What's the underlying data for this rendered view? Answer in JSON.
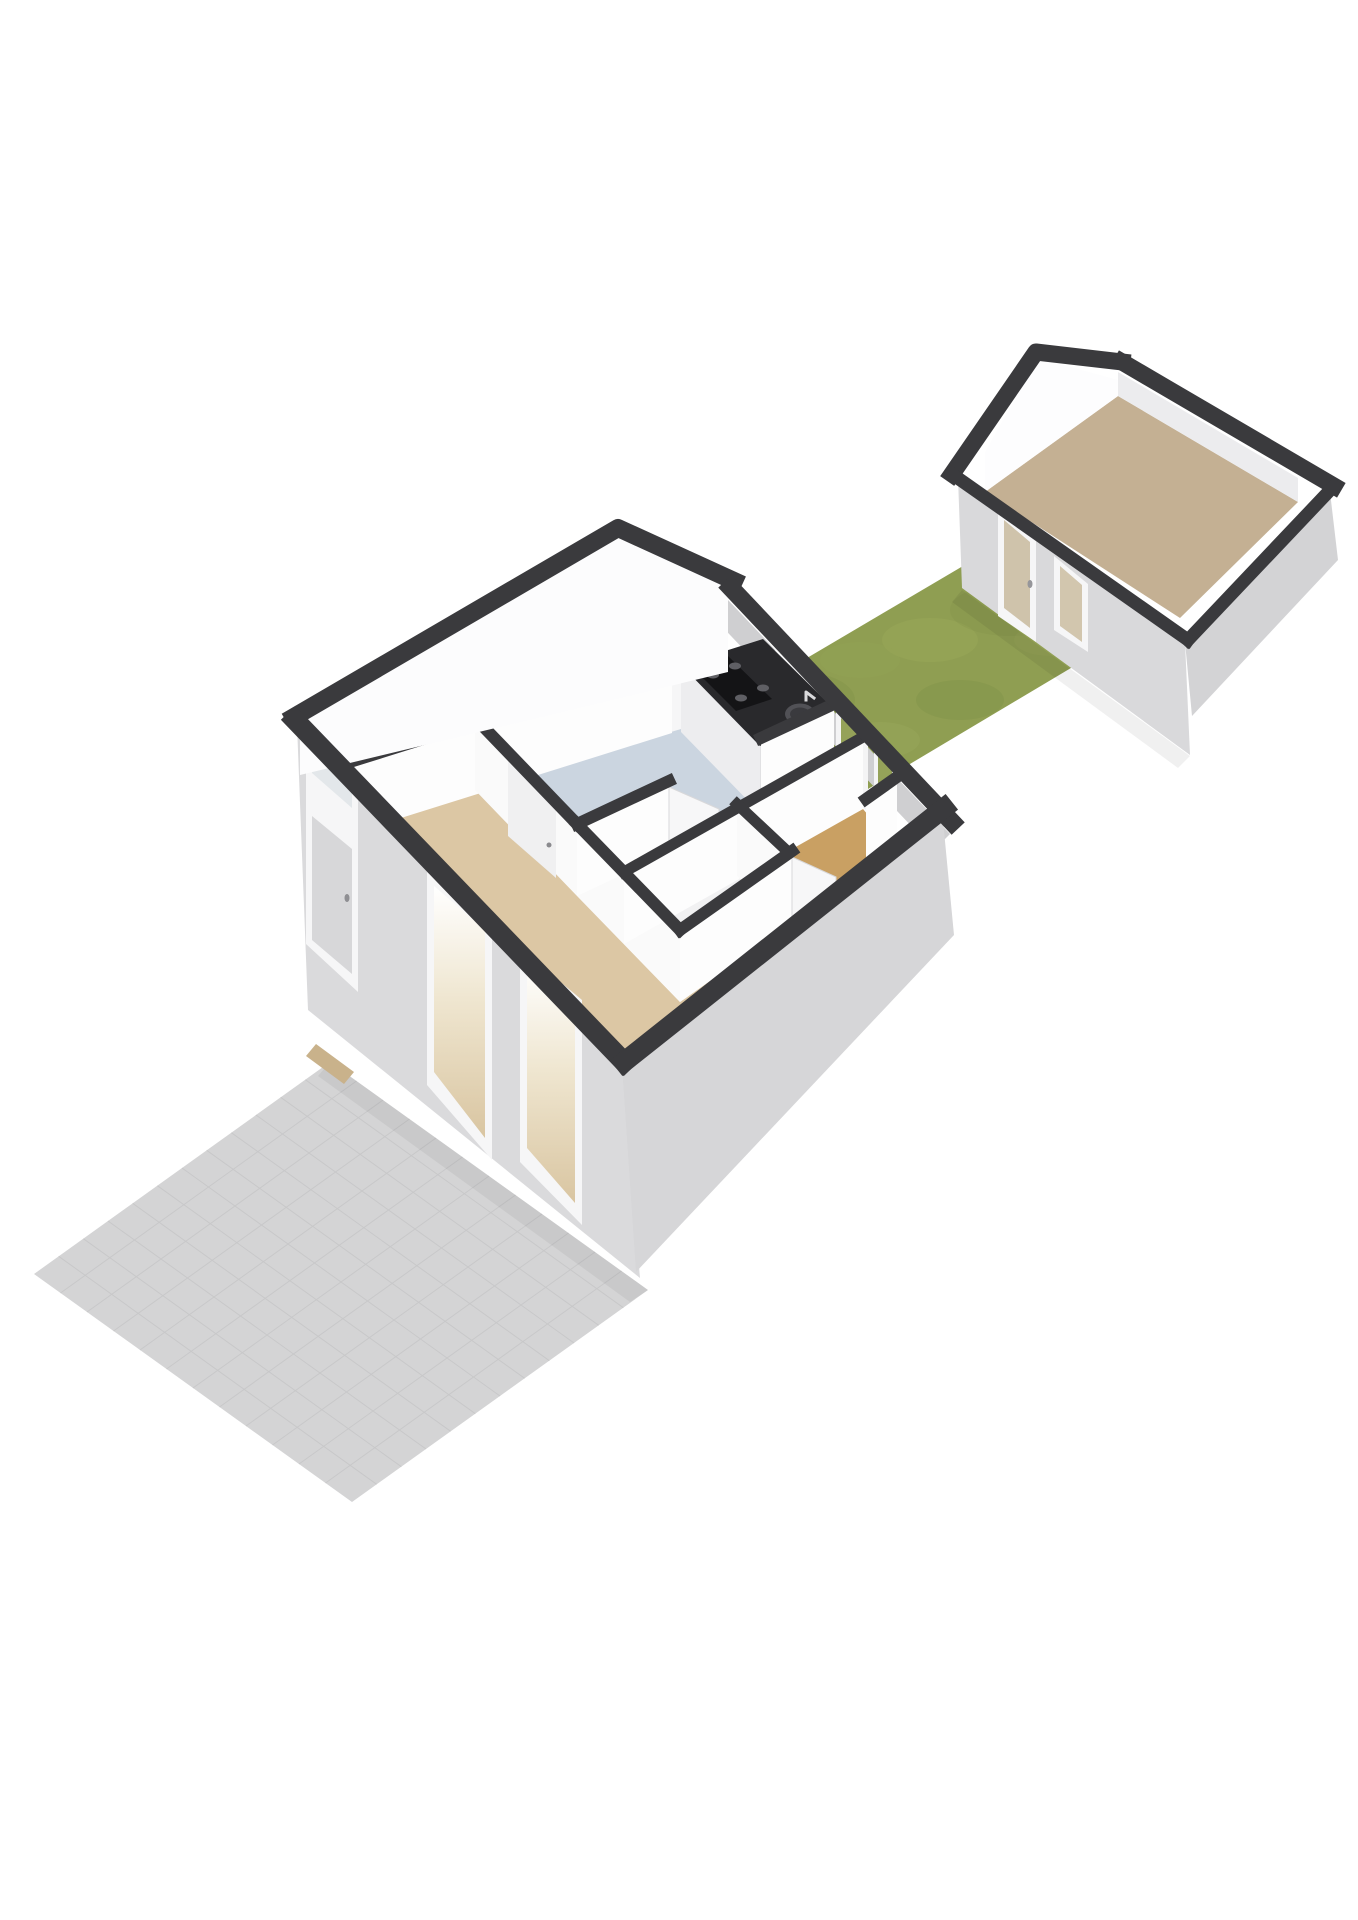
{
  "meta": {
    "description": "3D isometric floor plan render: tiled patio (bottom-left), main house ground floor with kitchen, hall, bathroom, toilet and living room, grass garden and detached shed (top-right)",
    "canvas": {
      "width": 1358,
      "height": 1920,
      "background": "#ffffff"
    },
    "palette": {
      "wall_top": "#3a3a3d",
      "wall_exterior": "#d9d9db",
      "wall_interior": "#fdfdfd",
      "kitchen_floor": "#cbd5e0",
      "living_floor": "#dcc7a4",
      "toilet_floor": "#c9a063",
      "shed_floor": "#c4b093",
      "grass": "#8f9e52",
      "patio": "#d4d4d5",
      "counter_top": "#29292c",
      "glass_to_garden": "#95a259"
    },
    "rooms": [
      {
        "name": "entry-corridor",
        "floor": "#f6f6f7"
      },
      {
        "name": "kitchen",
        "floor": "#cbd5e0"
      },
      {
        "name": "inner-hall",
        "floor": "#f6f6f7"
      },
      {
        "name": "bathroom",
        "floor": "#f1f1f2"
      },
      {
        "name": "toilet",
        "floor": "#c9a063"
      },
      {
        "name": "living-room",
        "floor": "#dcc7a4"
      },
      {
        "name": "shed",
        "floor": "#c4b093"
      }
    ]
  },
  "scene": {
    "layers": [
      {
        "name": "patio-surface",
        "kind": "polygon",
        "points": "330,1062 648,1290 352,1502 34,1274",
        "fill": "#d4d4d5"
      },
      {
        "name": "patio-tile-grid",
        "kind": "grid",
        "quad": "330,1062 648,1290 352,1502 34,1274",
        "div": 12,
        "stroke": "#c6c6c8",
        "width": 1,
        "opacity": 0.85
      },
      {
        "name": "patio-house-shadow",
        "kind": "polygon",
        "points": "330,1062 648,1290 630,1302 318,1076",
        "fill": "#000000",
        "opacity": 0.05
      },
      {
        "name": "front-door-threshold",
        "kind": "polygon",
        "points": "316,1044 354,1072 344,1084 306,1056",
        "fill": "#c9b28b"
      },
      {
        "name": "garden-grass",
        "kind": "polygon",
        "points": "690,727 1002,543 1128,634 816,820",
        "fill": "#8f9e52"
      },
      {
        "name": "grass-texture-blob",
        "kind": "ellipse",
        "cx": 800,
        "cy": 700,
        "rx": 55,
        "ry": 28,
        "fill": "#7f9047",
        "opacity": 0.3
      },
      {
        "name": "grass-texture-blob",
        "kind": "ellipse",
        "cx": 930,
        "cy": 640,
        "rx": 48,
        "ry": 22,
        "fill": "#a2b05f",
        "opacity": 0.28
      },
      {
        "name": "grass-texture-blob",
        "kind": "ellipse",
        "cx": 1010,
        "cy": 610,
        "rx": 60,
        "ry": 26,
        "fill": "#7f9047",
        "opacity": 0.25
      },
      {
        "name": "grass-texture-blob",
        "kind": "ellipse",
        "cx": 880,
        "cy": 740,
        "rx": 40,
        "ry": 18,
        "fill": "#a6b263",
        "opacity": 0.22
      },
      {
        "name": "grass-texture-blob",
        "kind": "ellipse",
        "cx": 960,
        "cy": 700,
        "rx": 44,
        "ry": 20,
        "fill": "#7c8d45",
        "opacity": 0.3
      },
      {
        "name": "grass-texture-blob",
        "kind": "ellipse",
        "cx": 1050,
        "cy": 640,
        "rx": 36,
        "ry": 16,
        "fill": "#9aa85a",
        "opacity": 0.25
      },
      {
        "name": "grass-texture-blob",
        "kind": "ellipse",
        "cx": 760,
        "cy": 760,
        "rx": 50,
        "ry": 22,
        "fill": "#7c8d45",
        "opacity": 0.22
      },
      {
        "name": "grass-texture-blob",
        "kind": "ellipse",
        "cx": 860,
        "cy": 660,
        "rx": 40,
        "ry": 18,
        "fill": "#95a455",
        "opacity": 0.3
      },
      {
        "name": "garden-house-shadow",
        "kind": "polygon",
        "points": "698,726 860,864 844,872 688,738",
        "fill": "#000000",
        "opacity": 0.07
      },
      {
        "name": "shed-grass-shadow",
        "kind": "polygon",
        "points": "962,590 1190,756 1178,768 952,602",
        "fill": "#000000",
        "opacity": 0.06
      },
      {
        "name": "shed-floor",
        "kind": "polygon",
        "points": "985,492 1118,396 1298,502 1180,618",
        "fill": "#c4b093"
      },
      {
        "name": "shed-gable-inner-face",
        "kind": "polygon",
        "points": "985,492 1118,396 1118,380 1038,358 985,452",
        "fill": "#fdfdfe"
      },
      {
        "name": "shed-ne-inner-face",
        "kind": "polygon",
        "points": "1118,396 1298,502 1298,478 1118,372",
        "fill": "#ececee"
      },
      {
        "name": "shed-sw-ext-face",
        "kind": "polygon",
        "points": "958,478 1185,642 1190,755 962,588",
        "fill": "#d9d9db"
      },
      {
        "name": "shed-se-ext-face",
        "kind": "polygon",
        "points": "1185,642 1330,492 1338,560 1192,716",
        "fill": "#d3d3d5"
      },
      {
        "name": "shed-door-frame",
        "kind": "polygon",
        "points": "998,508 1036,539 1036,642 998,616",
        "fill": "#f6f6f7"
      },
      {
        "name": "shed-door-glass",
        "kind": "polygon",
        "points": "1004,520 1030,542 1030,628 1004,608",
        "fill": "#cfc3ab"
      },
      {
        "name": "shed-door-handle",
        "kind": "ellipse",
        "cx": 1030,
        "cy": 584,
        "rx": 2.5,
        "ry": 4,
        "fill": "#96969a"
      },
      {
        "name": "shed-window-frame",
        "kind": "polygon",
        "points": "1054,556 1088,584 1088,652 1054,630",
        "fill": "#f6f6f7"
      },
      {
        "name": "shed-window-glass",
        "kind": "polygon",
        "points": "1060,566 1082,585 1082,642 1060,626",
        "fill": "#d2c6ae"
      },
      {
        "name": "shed-gable-roof-band",
        "kind": "polyline",
        "points": "952,474 1036,352 1122,362",
        "stroke": "#3a3a3d",
        "width": 17
      },
      {
        "name": "shed-ne-wall-band",
        "kind": "polyline",
        "points": "1122,362 1334,486",
        "stroke": "#3a3a3d",
        "width": 17
      },
      {
        "name": "shed-se-wall-band",
        "kind": "polyline",
        "points": "1334,486 1188,640",
        "stroke": "#3a3a3d",
        "width": 13
      },
      {
        "name": "shed-sw-wall-band",
        "kind": "polyline",
        "points": "952,474 1188,640",
        "stroke": "#3a3a3d",
        "width": 13
      },
      {
        "name": "house-ne-wall-outer-face",
        "kind": "polygon",
        "points": "728,600 950,834 934,850 713,617",
        "fill": "#cfcfd1"
      },
      {
        "name": "floor-corridor",
        "kind": "polygon",
        "points": "300,775 728,672 762,705 353,833",
        "fill": "#f6f6f7"
      },
      {
        "name": "floor-kitchen",
        "kind": "polygon",
        "points": "475,790 762,705 834,776 577,896",
        "fill": "#cbd5e0"
      },
      {
        "name": "floor-inner-hall",
        "kind": "polygon",
        "points": "577,896 834,776 863,809 624,944",
        "fill": "#f6f6f7"
      },
      {
        "name": "floor-bathroom",
        "kind": "polygon",
        "points": "624,944 737,876 786,922 680,1002",
        "fill": "#f1f1f2"
      },
      {
        "name": "floor-toilet",
        "kind": "polygon",
        "points": "737,876 863,809 897,849 786,922",
        "fill": "#c9a063"
      },
      {
        "name": "floor-living-room",
        "kind": "polygon",
        "points": "353,833 475,790 680,1002 897,849 940,880 630,1140",
        "fill": "#dcc7a4"
      },
      {
        "name": "kitchen-window-frame",
        "kind": "polygon",
        "points": "775,650 825,694 825,762 775,716",
        "fill": "#f4f4f5"
      },
      {
        "name": "kitchen-window-glass",
        "kind": "polygon",
        "points": "781,661 819,694 819,752 781,717",
        "fill": "#95a259"
      },
      {
        "name": "back-door-frame",
        "kind": "polygon",
        "points": "836,708 868,736 868,812 836,786",
        "fill": "#f4f4f5"
      },
      {
        "name": "back-door-glass",
        "kind": "polygon",
        "points": "841,718 863,737 863,802 841,783",
        "fill": "#95a259"
      },
      {
        "name": "toilet-window-frame",
        "kind": "polygon",
        "points": "874,748 896,767 896,838 874,820",
        "fill": "#f4f4f5"
      },
      {
        "name": "toilet-window-glass",
        "kind": "polygon",
        "points": "878,756 892,768 892,828 878,816",
        "fill": "#95a259"
      },
      {
        "name": "kitchen-counter-front-face",
        "kind": "polygon",
        "points": "681,665 760,746 760,813 681,732",
        "fill": "#ededef"
      },
      {
        "name": "kitchen-counter-side-face",
        "kind": "polygon",
        "points": "760,746 834,709 834,776 760,813",
        "fill": "#e1e1e3"
      },
      {
        "name": "kitchen-counter-top",
        "kind": "polygon",
        "points": "681,665 763,639 834,709 760,746",
        "fill": "#29292c"
      },
      {
        "name": "cooktop",
        "kind": "polygon",
        "points": "692,667 728,656 772,699 736,711",
        "fill": "#141416"
      },
      {
        "name": "cooktop-burner",
        "kind": "ellipse",
        "cx": 713,
        "cy": 675,
        "rx": 6,
        "ry": 3.5,
        "fill": "#5f5f64"
      },
      {
        "name": "cooktop-burner",
        "kind": "ellipse",
        "cx": 735,
        "cy": 666,
        "rx": 6,
        "ry": 3.5,
        "fill": "#5f5f64"
      },
      {
        "name": "cooktop-burner",
        "kind": "ellipse",
        "cx": 741,
        "cy": 698,
        "rx": 6,
        "ry": 3.5,
        "fill": "#5f5f64"
      },
      {
        "name": "cooktop-burner",
        "kind": "ellipse",
        "cx": 763,
        "cy": 688,
        "rx": 6,
        "ry": 3.5,
        "fill": "#5f5f64"
      },
      {
        "name": "kitchen-sink-outer",
        "kind": "ellipse",
        "cx": 800,
        "cy": 714,
        "rx": 15,
        "ry": 10.5,
        "fill": "#515156"
      },
      {
        "name": "kitchen-sink-basin",
        "kind": "ellipse",
        "cx": 800,
        "cy": 714,
        "rx": 10,
        "ry": 6.5,
        "fill": "#3a3a3e"
      },
      {
        "name": "kitchen-faucet",
        "kind": "polyline",
        "points": "806,700 806,692 814,698",
        "stroke": "#d9d9db",
        "width": 3
      },
      {
        "name": "wall-corridor-face",
        "kind": "polygon",
        "points": "353,767 672,667 672,733 353,833",
        "fill": "#fdfdfd"
      },
      {
        "name": "wall-kitchen-living-face",
        "kind": "polygon",
        "points": "475,724 577,830 577,896 475,790",
        "fill": "#fafafa"
      },
      {
        "name": "kitchen-living-door-panel",
        "kind": "polygon",
        "points": "508,760 556,806 556,878 508,836",
        "fill": "#f0f0f1"
      },
      {
        "name": "kitchen-living-door-handle",
        "kind": "ellipse",
        "cx": 549,
        "cy": 845,
        "rx": 2.5,
        "ry": 2.5,
        "fill": "#8a8a8e"
      },
      {
        "name": "wall-living-bath-face",
        "kind": "polygon",
        "points": "577,830 680,936 680,1002 577,896",
        "fill": "#fafafa"
      },
      {
        "name": "kitchen-hall-wall-face-left",
        "kind": "polygon",
        "points": "577,830 669,787 669,853 577,896",
        "fill": "#fdfdfd"
      },
      {
        "name": "kitchen-open-door",
        "kind": "polygon",
        "points": "669,787 719,809 719,875 669,853",
        "fill": "#f7f7f8",
        "stroke": "#d8d8da",
        "strokeWidth": 1
      },
      {
        "name": "kitchen-hall-wall-face-right",
        "kind": "polygon",
        "points": "761,744 834,710 834,776 761,810",
        "fill": "#fdfdfd"
      },
      {
        "name": "wall-hall-bath-face",
        "kind": "polygon",
        "points": "624,878 863,743 863,809 624,944",
        "fill": "#fdfdfd"
      },
      {
        "name": "wall-bath-toilet-face",
        "kind": "polygon",
        "points": "737,810 786,856 786,922 737,876",
        "fill": "#fafafa"
      },
      {
        "name": "wall-bathblock-se-face-left",
        "kind": "polygon",
        "points": "680,936 792,857 792,923 680,1002",
        "fill": "#fdfdfd"
      },
      {
        "name": "toilet-open-door",
        "kind": "polygon",
        "points": "792,857 836,877 836,943 792,923",
        "fill": "#f7f7f8",
        "stroke": "#d8d8da",
        "strokeWidth": 1
      },
      {
        "name": "wall-bathblock-se-face-right",
        "kind": "polygon",
        "points": "866,805 897,783 897,849 866,871",
        "fill": "#fdfdfd"
      },
      {
        "name": "wall-corridor-band",
        "kind": "polyline",
        "points": "353,761 672,661",
        "stroke": "#3a3a3d",
        "width": 12
      },
      {
        "name": "wall-kitchen-living-band",
        "kind": "polyline",
        "points": "475,718 577,824",
        "stroke": "#3a3a3d",
        "width": 12
      },
      {
        "name": "wall-living-bath-band",
        "kind": "polyline",
        "points": "577,824 680,930",
        "stroke": "#3a3a3d",
        "width": 12
      },
      {
        "name": "wall-hall-bath-band",
        "kind": "polyline",
        "points": "624,872 863,737",
        "stroke": "#3a3a3d",
        "width": 11
      },
      {
        "name": "wall-bath-toilet-band",
        "kind": "polyline",
        "points": "737,804 786,850",
        "stroke": "#3a3a3d",
        "width": 11
      },
      {
        "name": "wall-bathblock-band-left",
        "kind": "polyline",
        "points": "680,930 792,851",
        "stroke": "#3a3a3d",
        "width": 12
      },
      {
        "name": "wall-bathblock-band-right",
        "kind": "polyline",
        "points": "866,799 897,777",
        "stroke": "#3a3a3d",
        "width": 12
      },
      {
        "name": "kitchen-hall-band-left",
        "kind": "polyline",
        "points": "577,824 669,781",
        "stroke": "#3a3a3d",
        "width": 12
      },
      {
        "name": "kitchen-hall-band-right",
        "kind": "polyline",
        "points": "761,738 834,704",
        "stroke": "#3a3a3d",
        "width": 12
      },
      {
        "name": "facade-face",
        "kind": "polygon",
        "points": "297,725 622,1065 640,1278 308,1010",
        "fill": "#dadadc"
      },
      {
        "name": "front-door-frame",
        "kind": "polygon",
        "points": "306,738 358,783 358,992 306,944",
        "fill": "#f6f6f7"
      },
      {
        "name": "front-door-transom",
        "kind": "polygon",
        "points": "312,750 352,785 352,808 312,773",
        "fill": "#e3e7ea"
      },
      {
        "name": "front-door-panel",
        "kind": "polygon",
        "points": "312,816 352,849 352,974 312,940",
        "fill": "#d7d7d9"
      },
      {
        "name": "front-door-handle",
        "kind": "ellipse",
        "cx": 347,
        "cy": 898,
        "rx": 2.5,
        "ry": 4,
        "fill": "#8f8f93"
      },
      {
        "name": "living-window-1-frame",
        "kind": "polygon",
        "points": "427,872 492,928 492,1160 427,1085",
        "fill": "#f6f6f7"
      },
      {
        "name": "living-window-1-glass",
        "kind": "polygon",
        "points": "434,886 485,930 485,1138 434,1072",
        "fill": "url(#glassGrad)"
      },
      {
        "name": "living-window-2-frame",
        "kind": "polygon",
        "points": "520,948 582,1000 582,1225 520,1162",
        "fill": "#f6f6f7"
      },
      {
        "name": "living-window-2-glass",
        "kind": "polygon",
        "points": "527,962 575,1002 575,1203 527,1148",
        "fill": "url(#glassGrad)"
      },
      {
        "name": "se-end-wall-face",
        "kind": "polygon",
        "points": "622,1065 942,810 954,935 636,1272",
        "fill": "#d6d6d8"
      },
      {
        "name": "gable-inner-face",
        "kind": "polygon",
        "points": "300,775 728,672 728,582 621,531 300,715",
        "fill": "#fcfcfd"
      },
      {
        "name": "gable-roof-band",
        "kind": "polyline",
        "points": "294,717 618,528 734,581",
        "stroke": "#3a3a3d",
        "width": 18
      },
      {
        "name": "ne-wall-band",
        "kind": "polyline",
        "points": "731,588 952,822",
        "stroke": "#3a3a3d",
        "width": 18
      },
      {
        "name": "facade-band",
        "kind": "polyline",
        "points": "295,720 624,1062",
        "stroke": "#3a3a3d",
        "width": 20
      },
      {
        "name": "se-wall-band",
        "kind": "polyline",
        "points": "624,1062 944,808",
        "stroke": "#3a3a3d",
        "width": 20
      }
    ]
  }
}
